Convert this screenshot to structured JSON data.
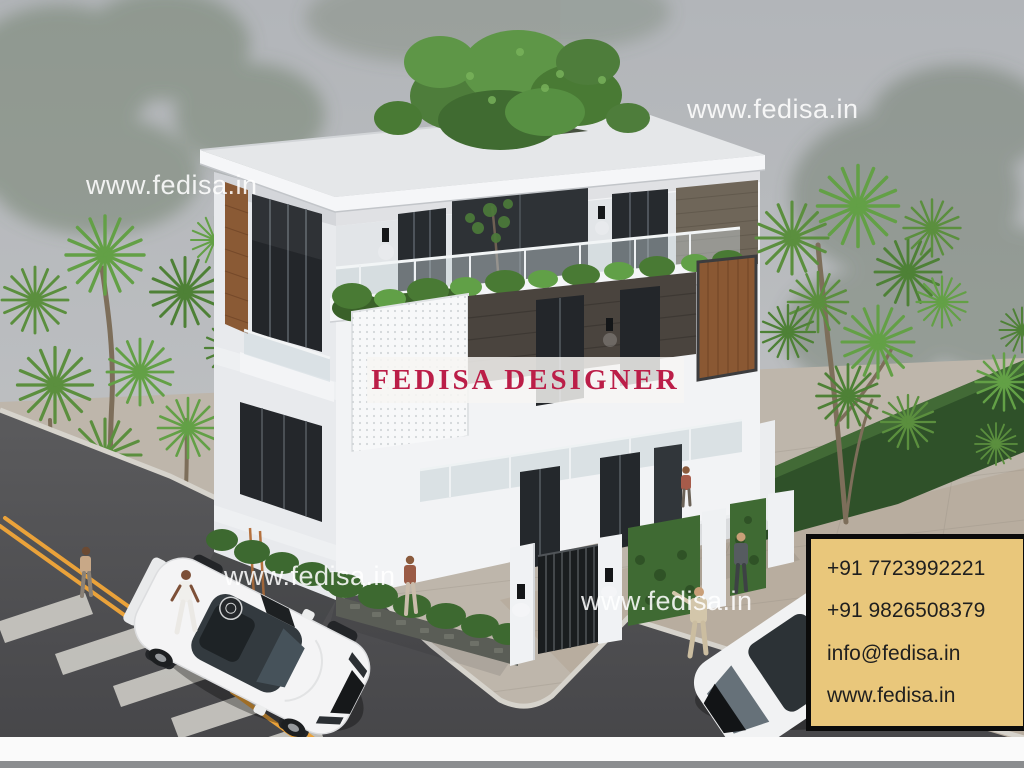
{
  "watermark": {
    "text": "www.fedisa.in"
  },
  "banner": {
    "text": "FEDISA DESIGNER",
    "text_color": "#bb1e48"
  },
  "contact_card": {
    "background": "#e9c77b",
    "border_color": "#0b0b0b",
    "text_color": "#1f1f1f",
    "lines": [
      "+91 7723992221",
      "+91 9826508379",
      "info@fedisa.in",
      "www.fedisa.in"
    ]
  },
  "palette": {
    "sky": "#b7babd",
    "wall_white": "#f2f3f5",
    "window_dark": "#24282c",
    "wood": "#8a5833",
    "foliage": "#5b8f3e",
    "hedge": "#2f5129",
    "asphalt": "#505052",
    "road_line_yellow": "#eaa23a",
    "pavement": "#beb6ab"
  }
}
